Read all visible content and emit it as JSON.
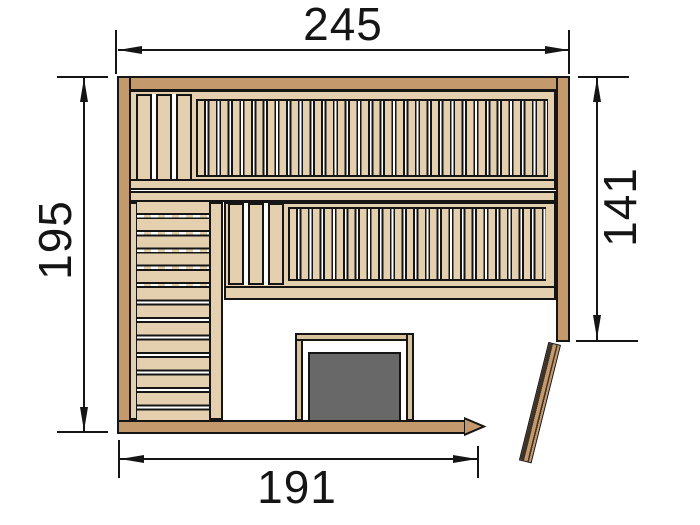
{
  "diagram": {
    "type": "sauna floor plan",
    "dimensions": {
      "top_width": "245",
      "left_height": "195",
      "right_height": "141",
      "bottom_width": "191"
    },
    "colors": {
      "wall": "#c49a6c",
      "bench": "#e4cfae",
      "slat_gap": "#ffffff",
      "outline": "#151515",
      "heater": "#686868",
      "door_dark": "#3f3226",
      "background": "#ffffff"
    },
    "components": [
      "walls",
      "top-bench",
      "middle-bench",
      "side-bench",
      "heater",
      "heater-guard",
      "door"
    ]
  }
}
